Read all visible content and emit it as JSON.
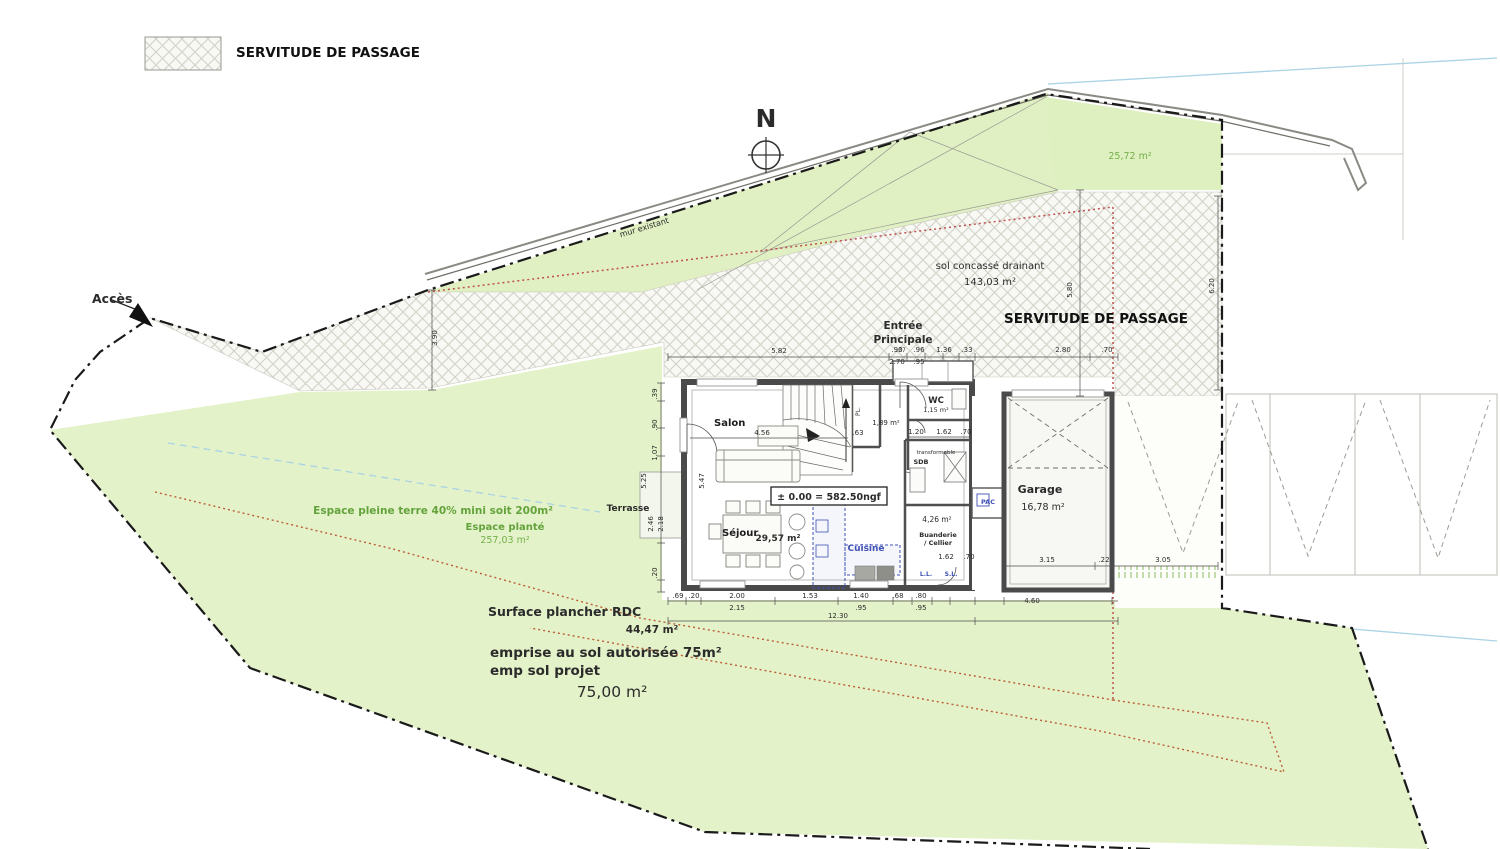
{
  "legend": {
    "label": "SERVITUDE DE PASSAGE"
  },
  "compass": {
    "n": "N"
  },
  "labels": {
    "acces": "Accès",
    "mur_existant": "mur existant",
    "sol_concasse_1": "sol  concassé drainant",
    "sol_concasse_2": "143,03 m²",
    "servitude": "SERVITUDE DE PASSAGE",
    "area_top_right": "25,72 m²",
    "entree_1": "Entrée",
    "entree_2": "Principale",
    "espace_pleine_terre": "Espace pleine terre 40% mini soit 200m²",
    "espace_plante": "Espace planté",
    "espace_plante_area": "257,03 m²",
    "terrasse": "Terrasse",
    "surface_plancher": "Surface plancher RDC",
    "surface_plancher_area": "44,47 m²",
    "emprise_autorisee": "emprise au sol autorisée 75m²",
    "emp_sol_projet": "emp sol projet",
    "emp_sol_area": "75,00 m²"
  },
  "rooms": {
    "salon": "Salon",
    "sejour": "Séjour",
    "sejour_area": "29,57 m²",
    "cuisine": "Cuisine",
    "wc": "WC",
    "wc_area": "1,15 m²",
    "pl": "PL.",
    "hall_area": "1,89 m²",
    "transformable": "transformable",
    "sdb": "SDB",
    "buanderie_area": "4,26 m²",
    "buanderie": "Buanderie",
    "cellier": "/ Cellier",
    "pac": "PAC",
    "ll": "L.L.",
    "sl": "S.L.",
    "garage": "Garage",
    "garage_area": "16,78 m²",
    "level": "± 0.00 = 582.50ngf"
  },
  "dims": {
    "top": [
      "5.82",
      ".90",
      "2.70",
      ".96",
      ".95",
      "1.36",
      ".33",
      "2.80",
      ".70",
      ".37"
    ],
    "bottom": [
      ".69",
      ".20",
      "2.00",
      "2.15",
      "1.53",
      "1.40",
      ".95",
      ".68",
      ".80",
      ".95",
      "12.30",
      "4.60"
    ],
    "garage": [
      "3.15",
      ".22",
      "3.05"
    ],
    "left": [
      ".39",
      ".90",
      "1.07",
      "5.25",
      "2.46",
      "2.18",
      ".20",
      "5.47"
    ],
    "right": [
      "5.80",
      "6.20",
      "3.90"
    ],
    "inner": [
      "4.56",
      ".63",
      "1.20",
      "1.62",
      ".70",
      "1.62",
      ".70"
    ]
  },
  "colors": {
    "green_fill": "#e4f2c9",
    "green_text": "#63a33c",
    "hatch_line": "#d2d2c8",
    "wall_dark": "#4a4a4a",
    "boundary": "#1a1a1a",
    "red_limit": "#c0504d",
    "red_limit_low": "#bb5e35",
    "water_blue": "#a9d3e4",
    "kitchen_blue": "#3f51b5"
  }
}
